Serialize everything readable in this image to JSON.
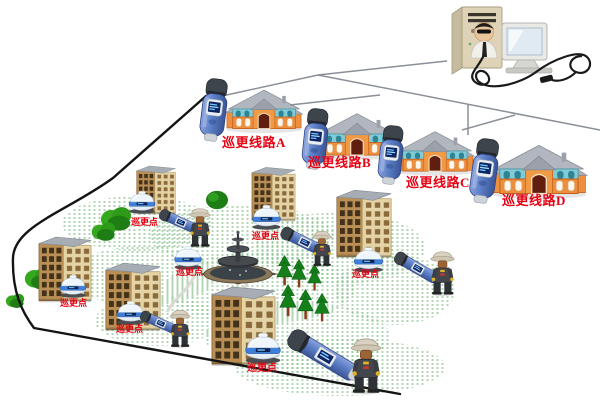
{
  "diagram": {
    "routes": [
      {
        "id": "A",
        "label": "巡更线路A"
      },
      {
        "id": "B",
        "label": "巡更线路B"
      },
      {
        "id": "C",
        "label": "巡更线路C"
      },
      {
        "id": "D",
        "label": "巡更线路D"
      }
    ],
    "patrol_points": [
      {
        "label": "巡更点"
      },
      {
        "label": "巡更点"
      },
      {
        "label": "巡更点"
      },
      {
        "label": "巡更点"
      },
      {
        "label": "巡更点"
      },
      {
        "label": "巡更点"
      },
      {
        "label": "巡更点"
      }
    ],
    "colors": {
      "label_red": "#e60012",
      "device_blue": "#5b7ec6",
      "device_cap_slate": "#3d444c",
      "dome_band_blue": "#3f7fd9",
      "house_orange": "#ec8f3e",
      "house_teal": "#7fccd7",
      "tower_tan": "#b98f55",
      "boundary_line_black": "#141414",
      "connection_line_gray": "#8a8f98"
    },
    "icons": {
      "pc": "desktop-computer-with-operator-icon",
      "reader": "patrol-reader-device-icon",
      "checkpoint": "patrol-checkpoint-dome-icon",
      "guard": "security-guard-figure-icon",
      "house": "villa-house-icon",
      "tower": "apartment-building-icon",
      "fountain": "fountain-icon",
      "pine": "pine-tree-icon",
      "bush": "bush-icon"
    }
  }
}
